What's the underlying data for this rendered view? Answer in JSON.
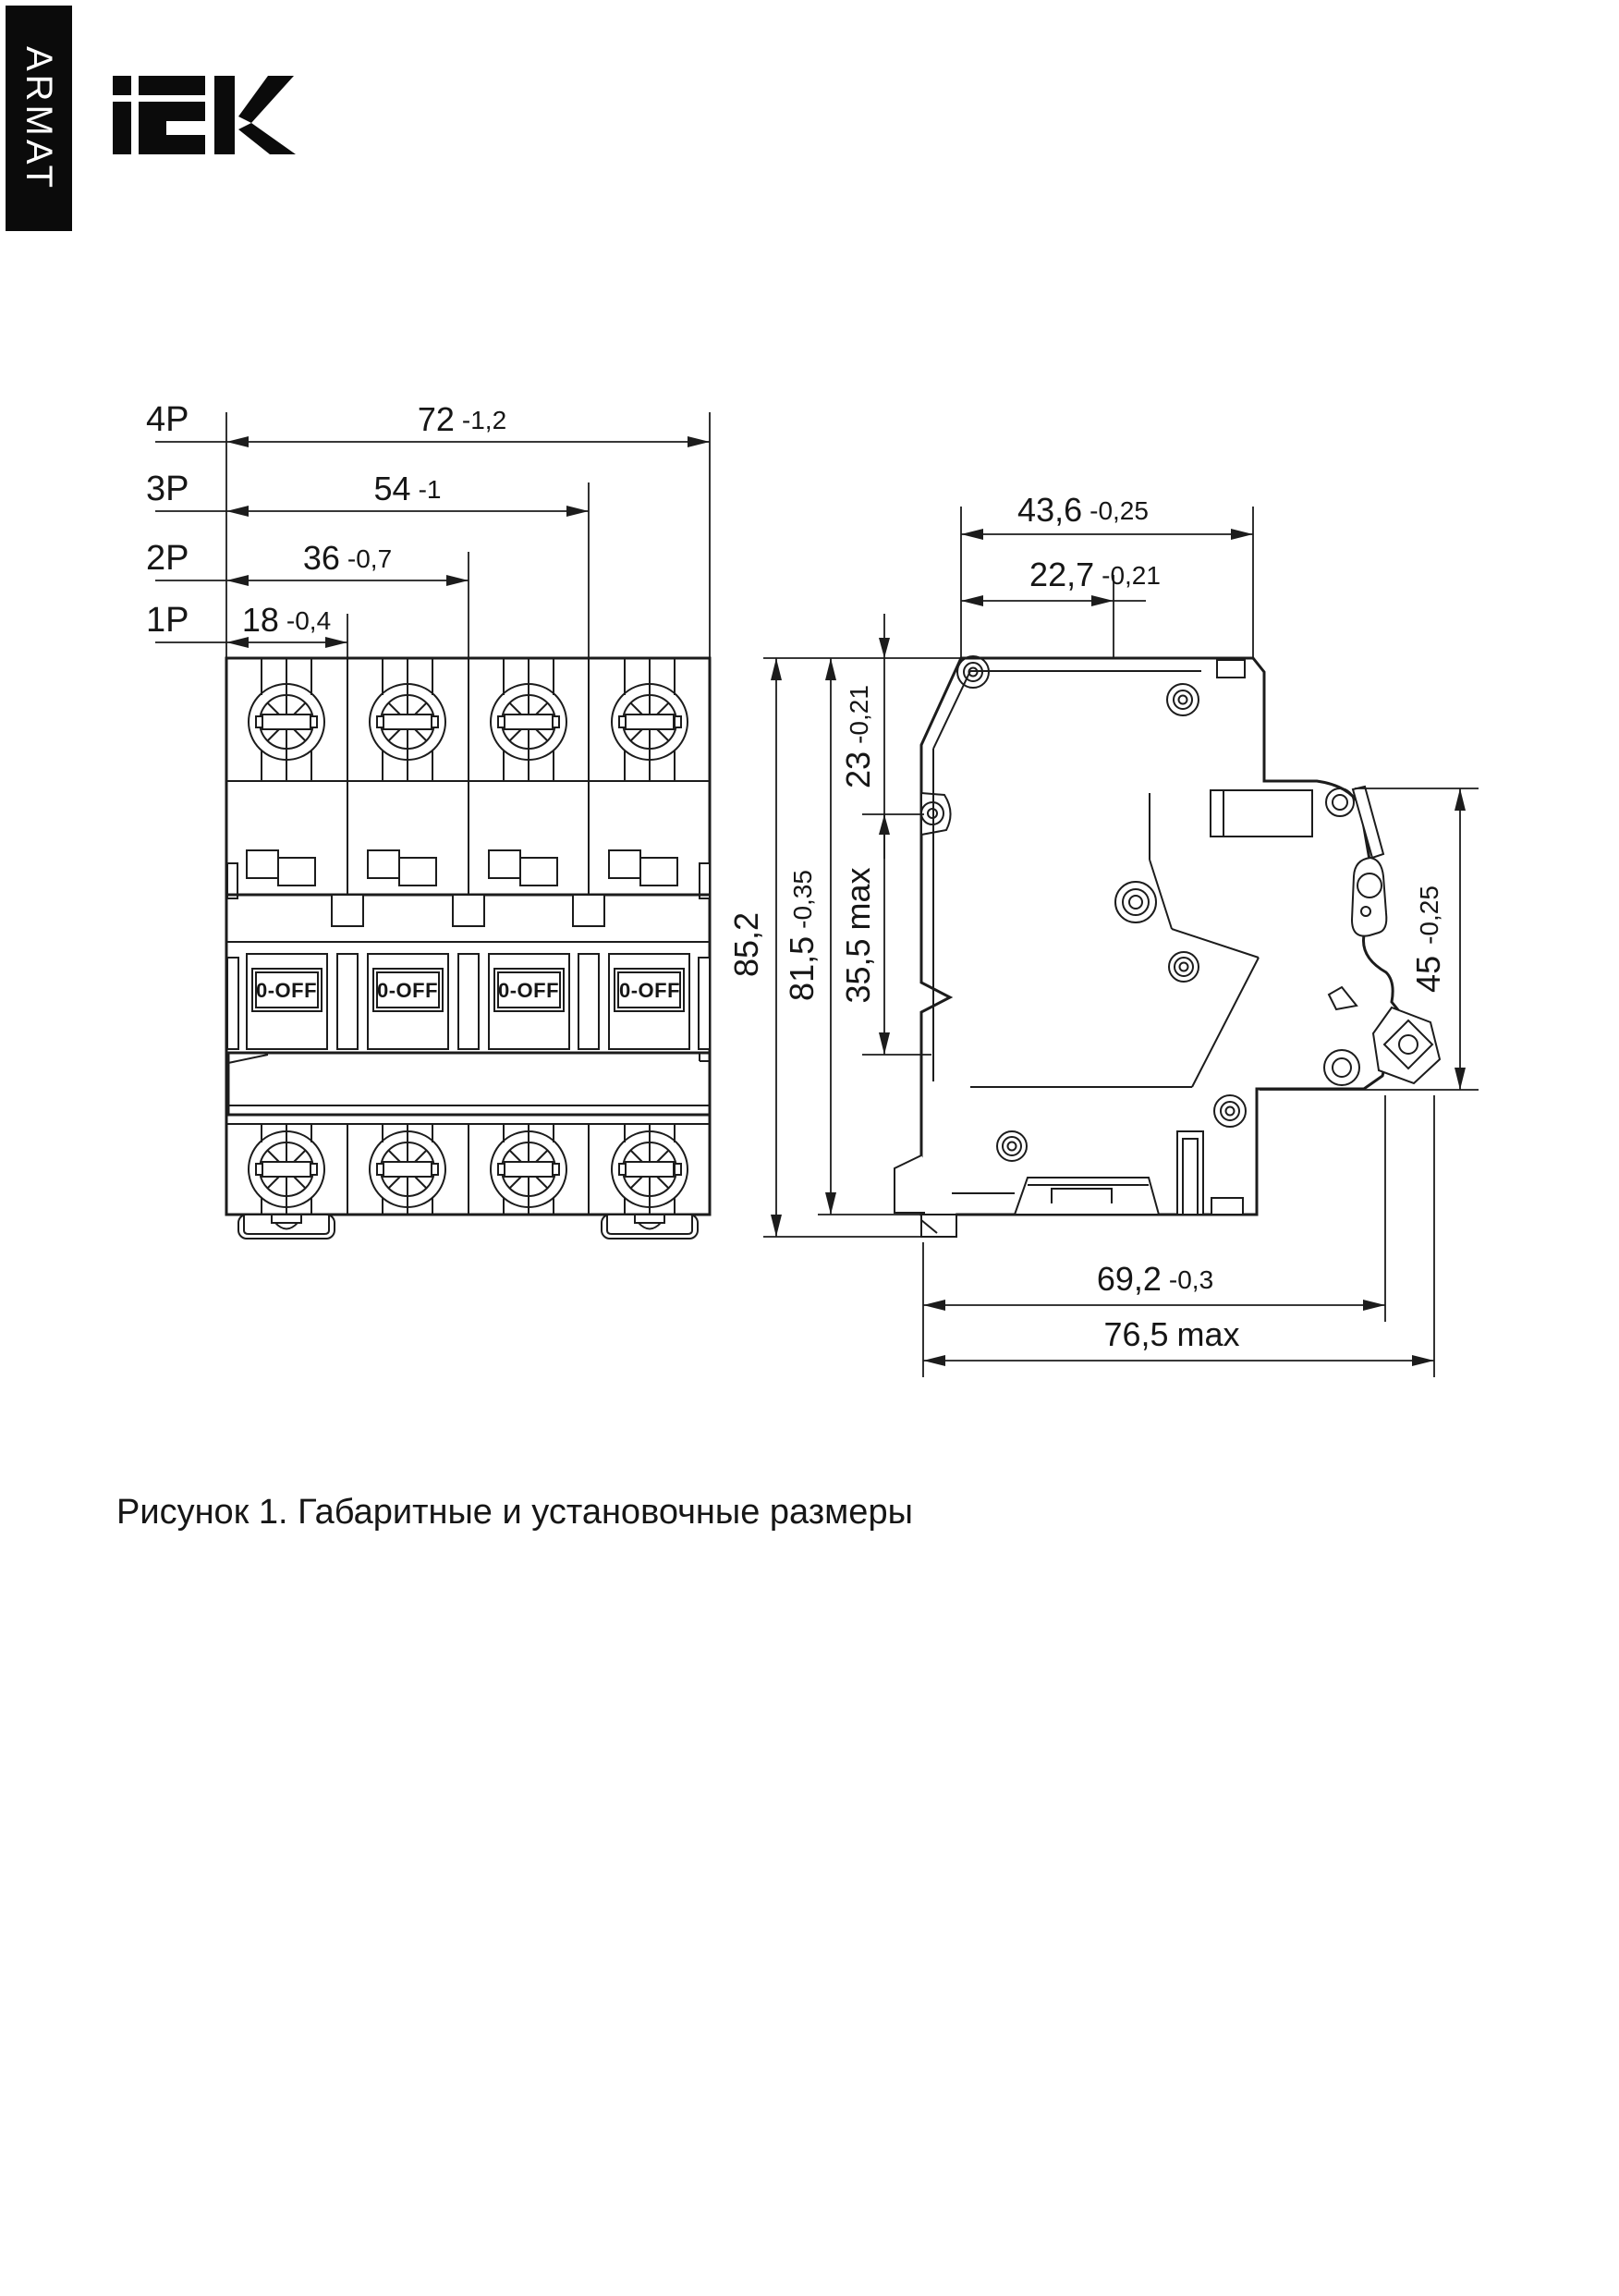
{
  "brand": {
    "sidebar_label": "ARMAT",
    "logo_text": "IEK"
  },
  "front_view": {
    "pole_dims": [
      {
        "pole": "4P",
        "value": "72",
        "qual": "-1,2"
      },
      {
        "pole": "3P",
        "value": "54",
        "qual": "-1"
      },
      {
        "pole": "2P",
        "value": "36",
        "qual": "-0,7"
      },
      {
        "pole": "1P",
        "value": "18",
        "qual": "-0,4"
      }
    ],
    "handle_labels": [
      "0-OFF",
      "0-OFF",
      "0-OFF",
      "0-OFF"
    ]
  },
  "side_view": {
    "dims": {
      "depth_top": {
        "value": "43,6",
        "qual": "-0,25"
      },
      "depth_din": {
        "value": "22,7",
        "qual": "-0,21"
      },
      "offset_top": {
        "value": "23",
        "qual": "-0,21"
      },
      "height_total": {
        "value": "85,2",
        "qual": ""
      },
      "height_body": {
        "value": "81,5",
        "qual": "-0,35"
      },
      "front_depth": {
        "value": "35,5",
        "qual": "max"
      },
      "panel_height": {
        "value": "45",
        "qual": "-0,25"
      },
      "depth_body": {
        "value": "69,2",
        "qual": "-0,3"
      },
      "depth_max": {
        "value": "76,5",
        "qual": "max"
      }
    }
  },
  "caption": "Рисунок 1. Габаритные и установочные размеры"
}
